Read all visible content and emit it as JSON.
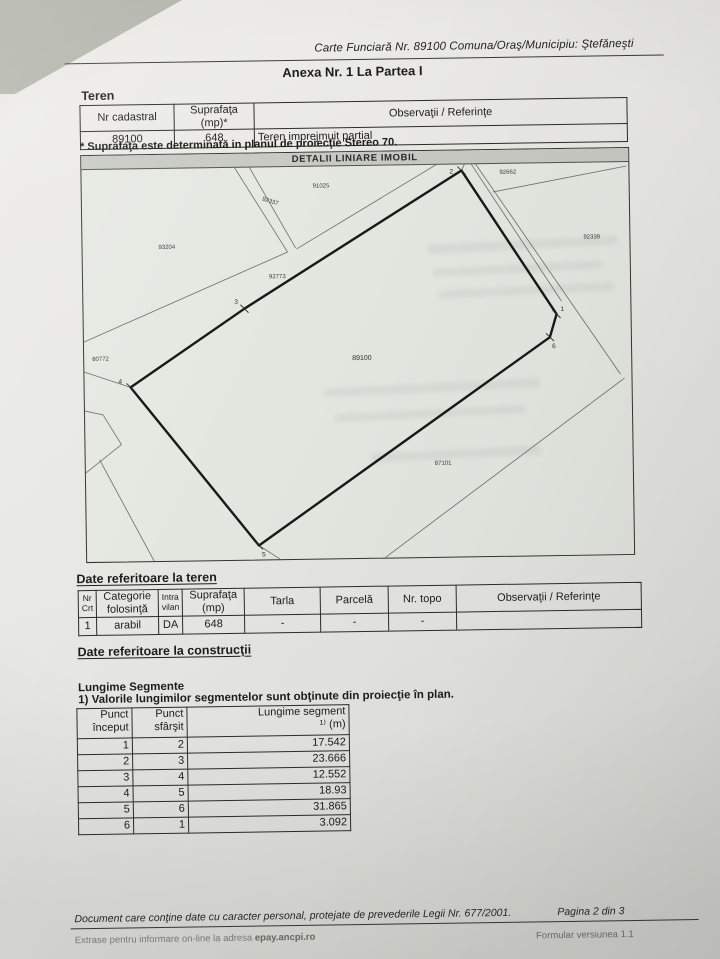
{
  "document": {
    "header": {
      "register_line": "Carte Funciară Nr. 89100 Comuna/Oraş/Municipiu: Ştefăneşti",
      "annex_title": "Anexa Nr. 1 La Partea I"
    },
    "teren": {
      "heading": "Teren",
      "columns": [
        "Nr cadastral",
        "Suprafaţa (mp)*",
        "Observaţii / Referinţe"
      ],
      "row": [
        "89100",
        "648",
        "Teren imprejmuit partial"
      ],
      "note": "* Suprafaţa este determinată in planul de proiecţie Stereo 70."
    },
    "map": {
      "title": "DETALII LINIARE IMOBIL",
      "main_parcel": "89100",
      "parcels": [
        "92662",
        "91025",
        "92337",
        "93204",
        "92773",
        "92339",
        "80772",
        "87101"
      ],
      "vertices": [
        "1",
        "2",
        "3",
        "4",
        "5",
        "6"
      ]
    },
    "teren_details": {
      "heading": "Date referitoare la teren",
      "columns": [
        "Nr Crt",
        "Categorie folosinţă",
        "Intra vilan",
        "Suprafaţa (mp)",
        "Tarla",
        "Parcelă",
        "Nr. topo",
        "Observaţii / Referinţe"
      ],
      "row": [
        "1",
        "arabil",
        "DA",
        "648",
        "-",
        "-",
        "-",
        ""
      ]
    },
    "constructii": {
      "heading": "Date referitoare la construcţii"
    },
    "segments": {
      "heading": "Lungime Segmente",
      "note": "1) Valorile lungimilor segmentelor sunt obţinute din proiecţie în plan.",
      "col_start": "Punct început",
      "col_end": "Punct sfârşit",
      "col_len_line1": "Lungime segment",
      "col_len_line2": "¹⁾ (m)",
      "rows": [
        [
          "1",
          "2",
          "17.542"
        ],
        [
          "2",
          "3",
          "23.666"
        ],
        [
          "3",
          "4",
          "12.552"
        ],
        [
          "4",
          "5",
          "18.93"
        ],
        [
          "5",
          "6",
          "31.865"
        ],
        [
          "6",
          "1",
          "3.092"
        ]
      ]
    },
    "footer": {
      "privacy": "Document care conţine date cu caracter personal, protejate de prevederile Legii Nr. 677/2001.",
      "page": "Pagina 2 din 3",
      "online_prefix": "Extrase pentru informare on-line la adresa",
      "online_site": "epay.ancpi.ro",
      "form_version": "Formular versiunea 1.1"
    }
  }
}
